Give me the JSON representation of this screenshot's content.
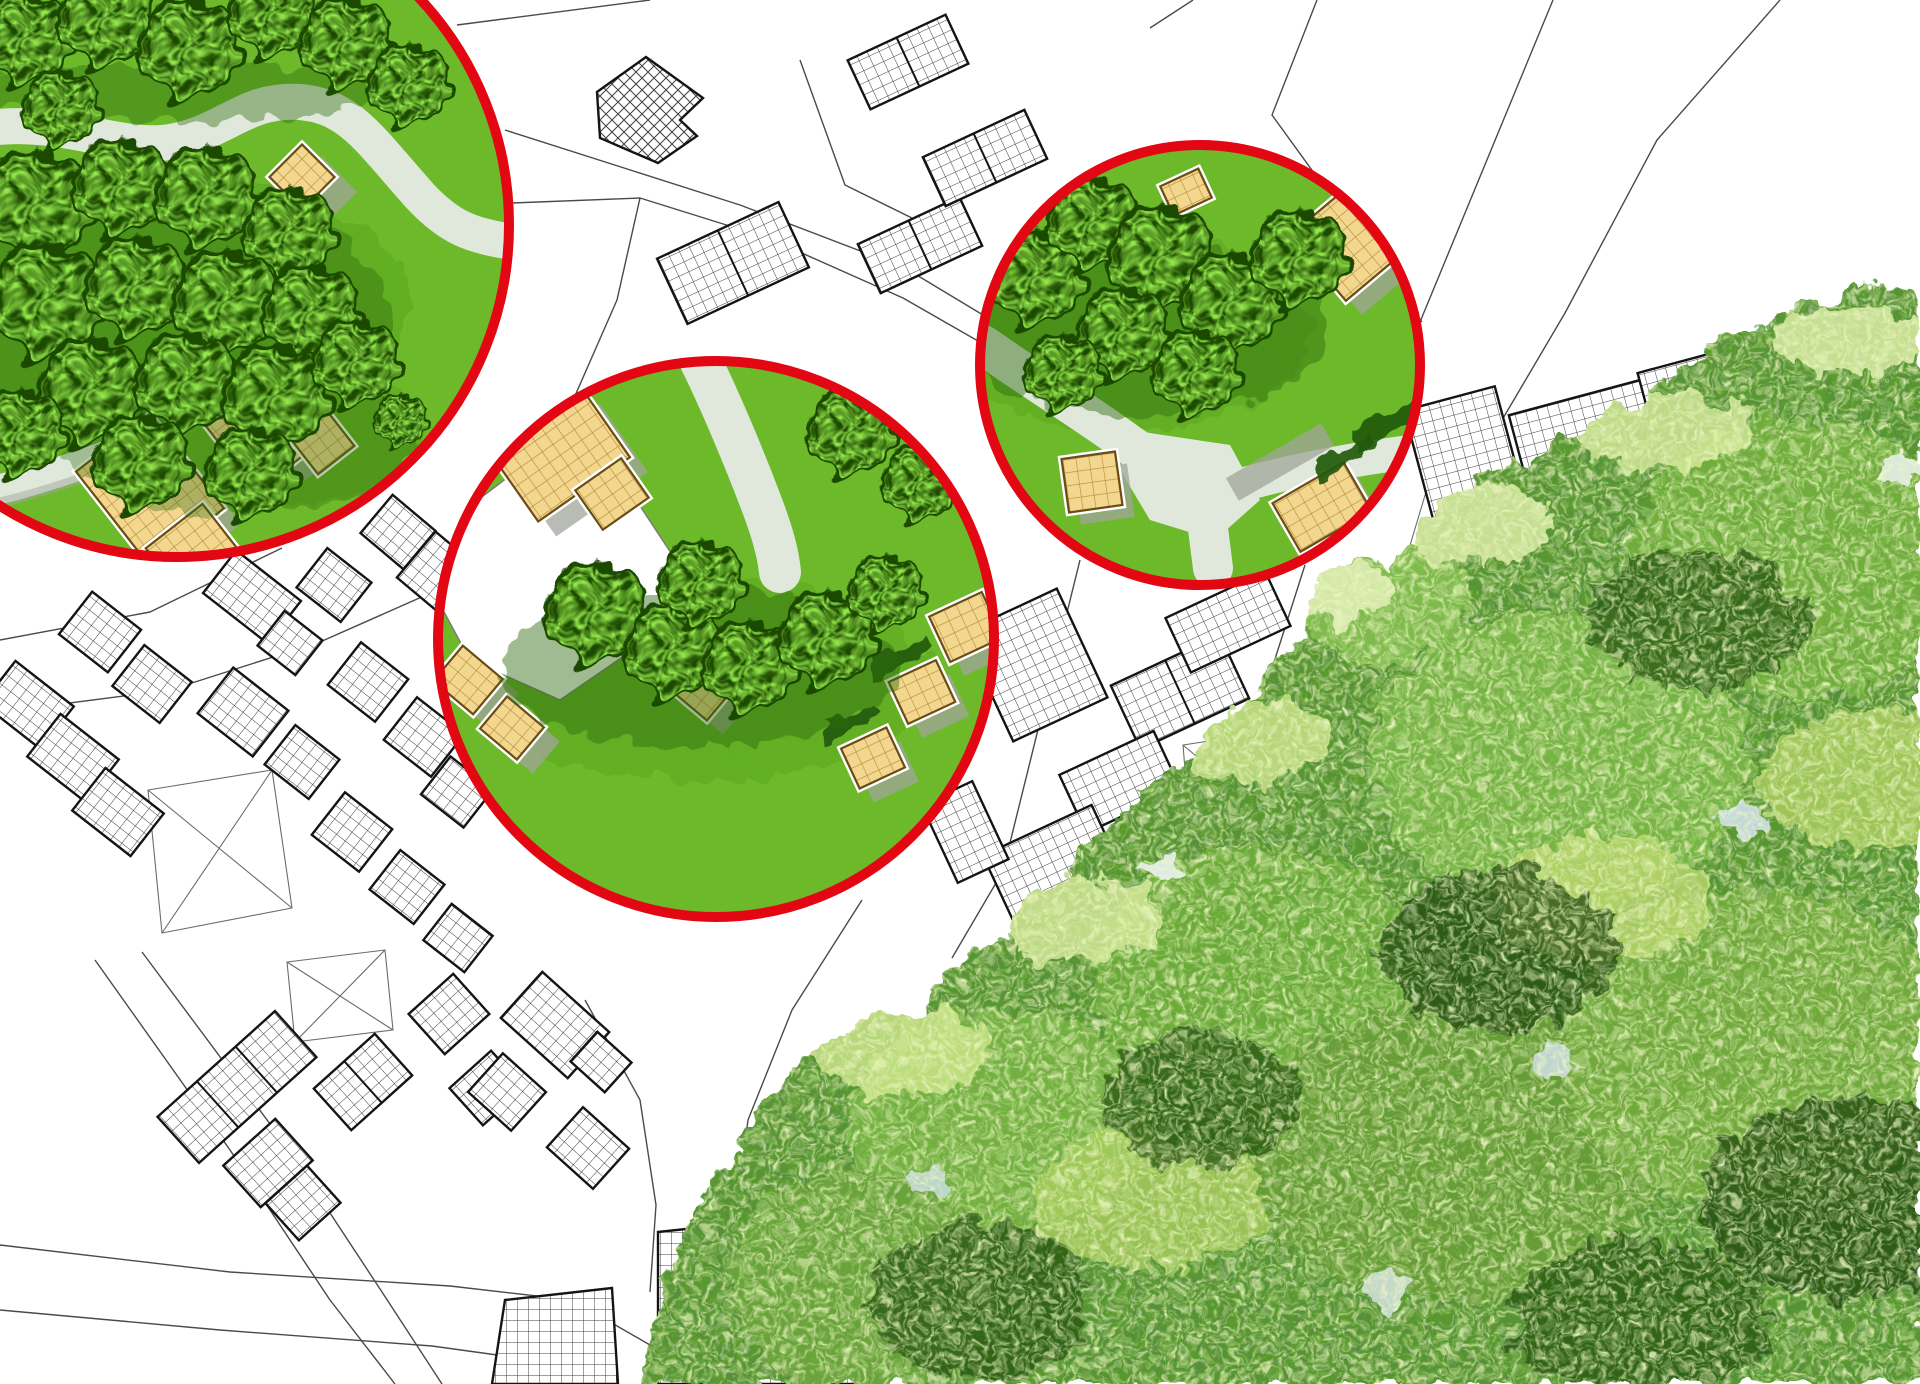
{
  "canvas": {
    "width": 1920,
    "height": 1384
  },
  "palette": {
    "background": "#ffffff",
    "ring-red": "#e30613",
    "lawn": "#6cbf28",
    "lawn-shade": "#4f9a18",
    "tree-dark": "#1c4a06",
    "tree-bright": "#49c414",
    "tree-shadow": "#2f6b10",
    "walk-path": "#dfe8da",
    "tan-fill": "#f3d78f",
    "tan-grid": "#b28a3a",
    "tan-outline": "#6a4c15",
    "shadow-gray": "#a2a69b",
    "parcel-line": "#4a4a4a",
    "building-outline": "#141414",
    "hatch-line": "#3f3f3f",
    "foliage-base": "#5a9a2e",
    "foliage-dark": "#23500f",
    "foliage-light": "#a3d162",
    "foliage-pale": "#e9f3c0",
    "sky-gap": "#cfdfeb"
  },
  "annotation_circles": [
    {
      "label": "detail-view-park",
      "cx": 177,
      "cy": 225,
      "r": 332
    },
    {
      "label": "detail-view-residential-green",
      "cx": 716,
      "cy": 639,
      "r": 278
    },
    {
      "label": "detail-view-garden",
      "cx": 1200,
      "cy": 365,
      "r": 220
    }
  ],
  "ring": {
    "stroke_width": 10
  }
}
